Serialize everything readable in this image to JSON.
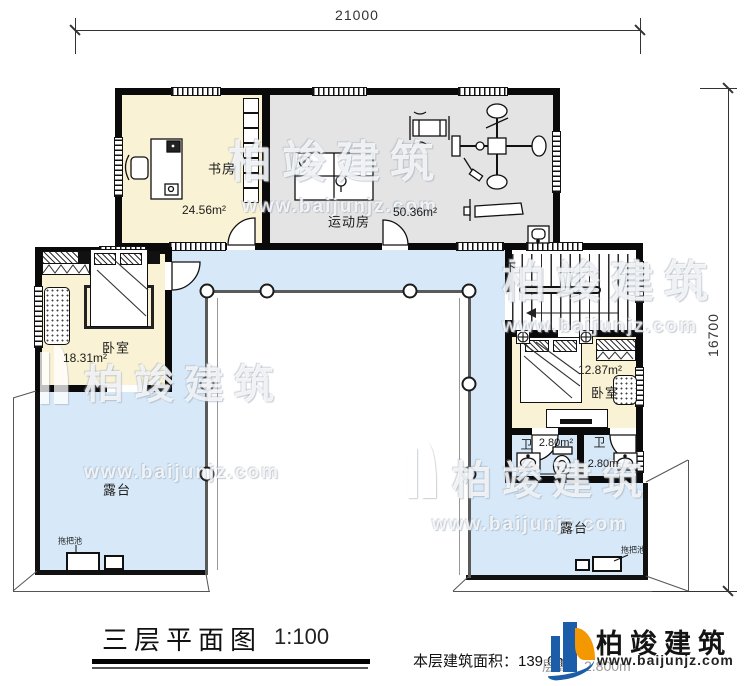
{
  "colors": {
    "room_yellow": "#FAF2D4",
    "room_gray": "#E4E4E4",
    "corridor_blue": "#D7E9F8",
    "wall_black": "#0A0A0A",
    "logo_blue": "#1B5DA8",
    "logo_orange": "#F39800"
  },
  "dimensions": {
    "top": "21000",
    "right": "16700"
  },
  "rooms": {
    "study": {
      "label": "书房",
      "area": "24.56m²"
    },
    "gym": {
      "label": "运动房",
      "area": "50.36m²"
    },
    "bedroom_left": {
      "label": "卧室",
      "area": "18.31m²"
    },
    "bedroom_right": {
      "label": "卧室",
      "area": "12.87m²"
    },
    "bath_left": {
      "label": "卫",
      "area": "2.80m²"
    },
    "bath_right": {
      "label": "卫",
      "area": "2.80m"
    },
    "terrace_left": {
      "label": "露台"
    },
    "terrace_right": {
      "label": "露台"
    },
    "stairs": {
      "label": "下"
    }
  },
  "fixtures": {
    "mop_sink_left": "拖把池",
    "mop_sink_right": "拖把池"
  },
  "footer": {
    "title": "三层平面图",
    "scale": "1:100",
    "area_note": "本层建筑面积：139.0m²",
    "floor_height_note": "层高：2.800m"
  },
  "brand": {
    "name": "柏竣建筑",
    "website": "www.baijunjz.com"
  },
  "watermarks": [
    {
      "name": "柏竣建筑",
      "website": "www.baijunjz.com"
    },
    {
      "name": "柏竣建筑",
      "website": "www.baijunjz.com"
    },
    {
      "name": "柏竣建筑",
      "website": "www.baijunjz.com"
    },
    {
      "name": "柏竣建筑",
      "website": "www.baijunjz.com"
    }
  ]
}
